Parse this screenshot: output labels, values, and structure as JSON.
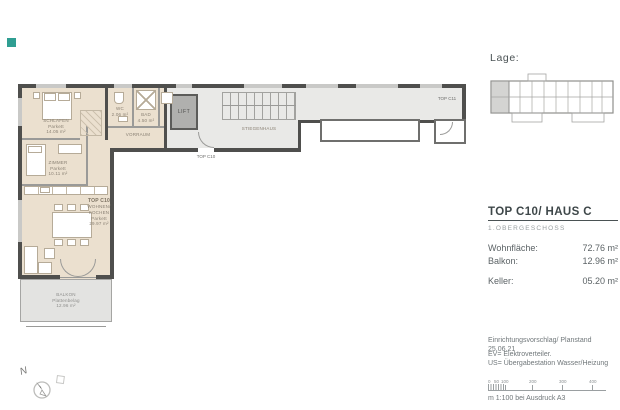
{
  "accent": {
    "teal": "#2f9e92"
  },
  "lage": {
    "label": "Lage:"
  },
  "unit": {
    "title": "TOP C10/ HAUS C",
    "floor": "1.OBERGESCHOSS",
    "areas": [
      {
        "label": "Wohnfläche:",
        "value": "72.76 m²"
      },
      {
        "label": "Balkon:",
        "value": "12.96 m²"
      },
      {
        "label": "Keller:",
        "value": "05.20 m²"
      }
    ]
  },
  "notes": {
    "line1": "Einrichtungsvorschlag/ Planstand 25.06.21",
    "line2": "EV= Elektroverteiler.",
    "line3": "US= Übergabestation Wasser/Heizung"
  },
  "scalebar": {
    "ticks": [
      "0",
      "50",
      "100",
      "200",
      "300",
      "400"
    ],
    "caption": "m 1:100 bei Ausdruck A3"
  },
  "plan": {
    "north_label": "N",
    "rooms": {
      "schlafen": {
        "name": "SCHLAFEN",
        "floor": "Parkett",
        "area": "14.05 m²"
      },
      "kind": {
        "name": "ZIMMER",
        "floor": "Parkett",
        "area": "10.11 m²"
      },
      "wc": {
        "name": "WC",
        "floor": "Fliesen",
        "area": "2.06 m²"
      },
      "bad": {
        "name": "BAD",
        "floor": "Fliesen",
        "area": "4.50 m²"
      },
      "vorraum": {
        "name": "VORRAUM",
        "floor": "Parkett",
        "area": "6.35 m²"
      },
      "wohnen": {
        "top": "TOP C10",
        "name": "WOHNEN/ KOCHEN",
        "floor": "Parkett",
        "area": "29.97 m²"
      },
      "balkon": {
        "name": "BALKON",
        "floor": "Plattenbelag",
        "area": "12.96 m²"
      },
      "lift": {
        "name": "LIFT"
      },
      "stiege": {
        "name": "STIEGENHAUS"
      },
      "entry": {
        "name": "TOP C10"
      },
      "neighbor": {
        "name": "TOP C11"
      }
    }
  }
}
